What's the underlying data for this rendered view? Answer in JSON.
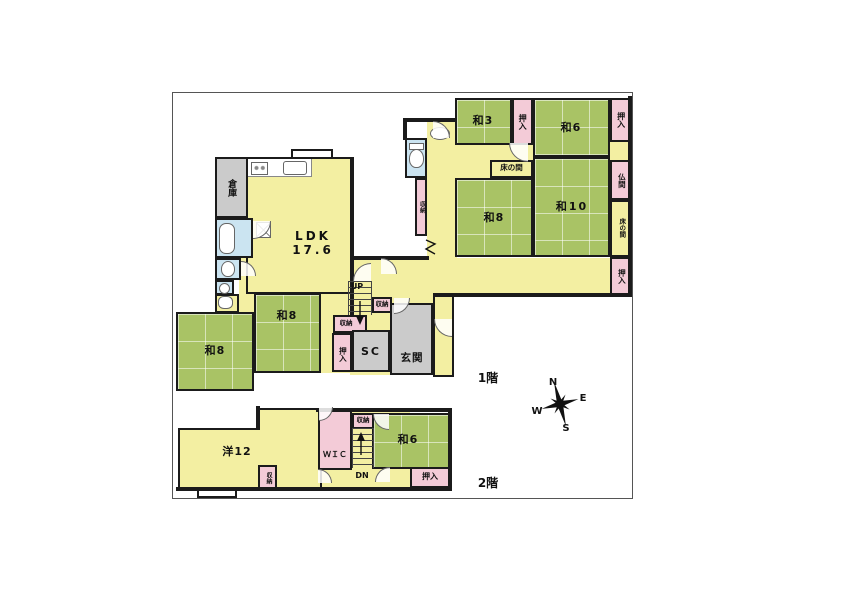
{
  "floor1": {
    "label": "1階",
    "ldk": {
      "name": "LDK",
      "size": "17.6"
    },
    "rooms": {
      "soko": "倉庫",
      "wa3": "和3",
      "wa6": "和6",
      "wa8_right": "和8",
      "wa10": "和10",
      "wa8_left": "和8",
      "wa8_mid": "和8",
      "genkan": "玄関",
      "sc": "SC",
      "butsuma": "仏間",
      "tokonoma_inner": "床の間",
      "tokonoma_right": "床の間",
      "oshiire_wa3": "押入",
      "oshiire_wa6": "押入",
      "oshiire_right": "押入",
      "oshiire_hall": "押入",
      "shuno_strip": "収納",
      "shuno_stairs": "収納",
      "shuno_hall": "収納",
      "up": "UP"
    }
  },
  "floor2": {
    "label": "2階",
    "rooms": {
      "yo12": "洋12",
      "wic": "ＷＩＣ",
      "wa6": "和6",
      "oshiire": "押入",
      "shuno_top": "収納",
      "shuno_small": "収納",
      "dn": "DN"
    }
  },
  "compass": {
    "n": "N",
    "e": "E",
    "s": "S",
    "w": "W"
  },
  "colors": {
    "tatami_green": "#a9c365",
    "floor_yellow": "#f3efa2",
    "closet_pink": "#f3cbd7",
    "wet_area_blue": "#cbe4f1",
    "utility_gray": "#cbcbcb",
    "wall": "#1b1b1b"
  }
}
